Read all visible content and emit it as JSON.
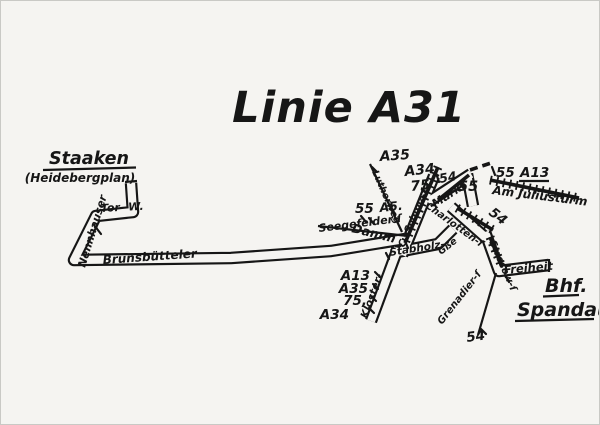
{
  "colors": {
    "paper": "#f5f4f1",
    "ink": "#161616"
  },
  "title": "Linie A31",
  "termini": {
    "west": {
      "name": "Staaken",
      "detail": "(Heidebergplan)"
    },
    "east": {
      "line1": "Bhf.",
      "line2": "Spandau"
    }
  },
  "streets": {
    "tor": "Tor- W.",
    "nennhauser": "Nennhauser",
    "brunsbuetteler": "Brunsbütteler",
    "damm": "Damm",
    "seegefelder": "Seegefelder ſ",
    "nw_street": "Lutherweg",
    "carl_schurz": "C.-Schurz-ſ",
    "markt": "Markt",
    "charlotten": "Charlotten-ſ",
    "stabholz": "Stabholz-",
    "stabholz_suffix": "Gße",
    "kloster": "Kloster-",
    "am_juliusturm": "Am Juliusturm",
    "stresow": "Stresow-ſ",
    "freiheit": "Freiheit",
    "grenadier": "Grenadier-ſ"
  },
  "connections": {
    "seegefelder_55": "55",
    "a5": "A5.",
    "nw_a35": "A35",
    "top_a34": "A34",
    "top_75": "75",
    "top_54": "54",
    "markt_55": "55",
    "juliusturm_55": "55",
    "juliusturm_a13": "A13",
    "stresow_54": "54",
    "grenadier_54": "54",
    "kloster_lines": [
      "A13",
      "A35",
      "75,",
      "A34"
    ]
  }
}
